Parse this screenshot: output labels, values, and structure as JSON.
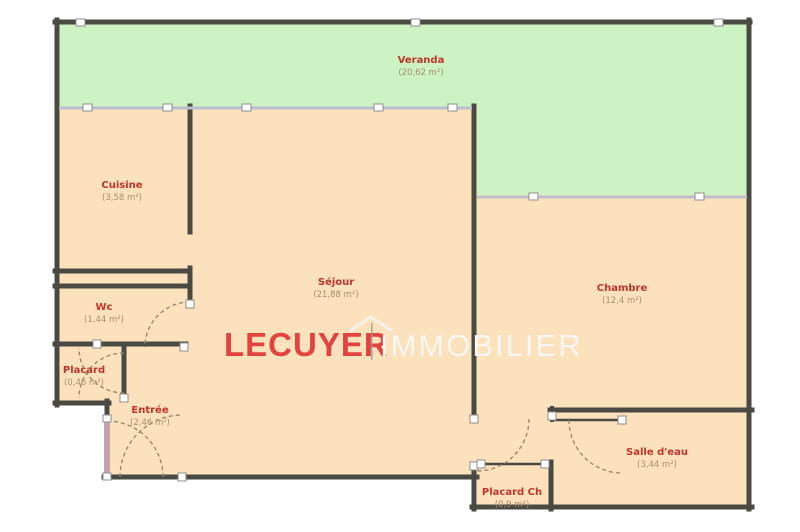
{
  "watermark": {
    "brand_primary": "LECUYER",
    "brand_secondary": "IMMOBILIER"
  },
  "rooms": [
    {
      "name": "Veranda",
      "area": "(20,62 m²)"
    },
    {
      "name": "Cuisine",
      "area": "(3,58 m²)"
    },
    {
      "name": "Séjour",
      "area": "(21,88 m²)"
    },
    {
      "name": "Chambre",
      "area": "(12,4 m²)"
    },
    {
      "name": "Wc",
      "area": "(1,44 m²)"
    },
    {
      "name": "Placard",
      "area": "(0,46 m²)"
    },
    {
      "name": "Entrée",
      "area": "(2,46 m²)"
    },
    {
      "name": "Salle d'eau",
      "area": "(3,44 m²)"
    },
    {
      "name": "Placard Ch",
      "area": "(0,9 m²)"
    }
  ],
  "colors": {
    "floor": "#fce1bd",
    "veranda_floor": "#cdf2c4",
    "wall": "#4a4a42",
    "glazing": "#b9bfcc",
    "room_name_text": "#c0342a",
    "room_area_text": "#a68f6e",
    "brand_red": "#e2433e",
    "brand_white": "#f8f7f3",
    "door_panel": "#c8a2aa"
  }
}
